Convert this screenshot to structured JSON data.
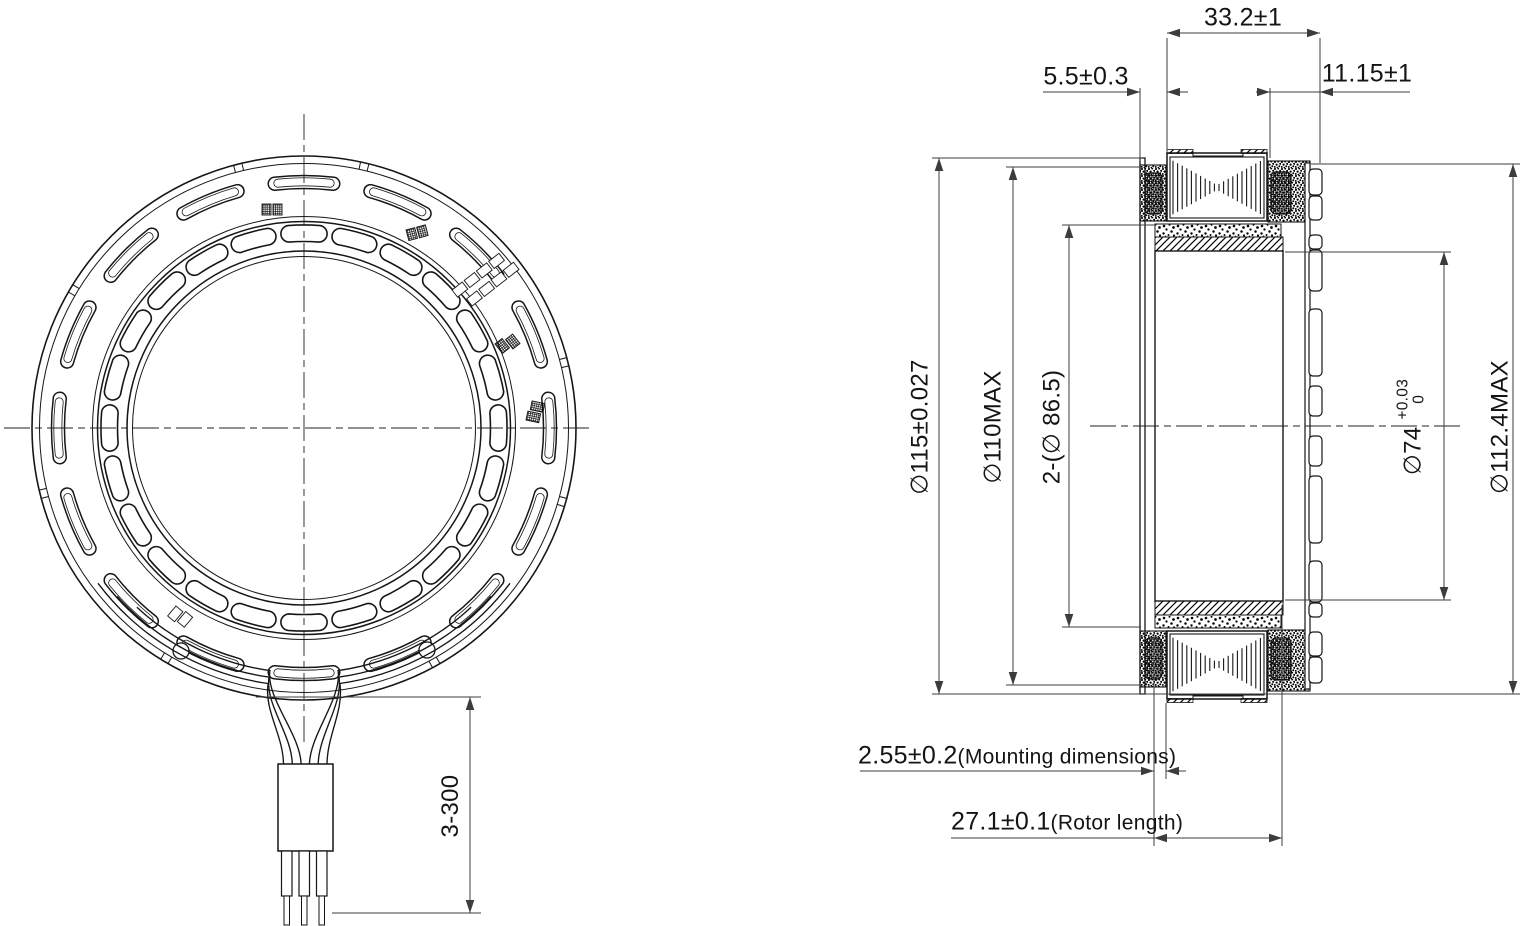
{
  "drawing": {
    "front_view": {
      "dim_wire_length": "3-300"
    },
    "section_view": {
      "dim_width_total": "33.2±1",
      "dim_width_left": "5.5±0.3",
      "dim_width_right": "11.15±1",
      "dim_outer_dia": "∅115±0.027",
      "dim_stator_dia": "∅110MAX",
      "dim_magnet_dia": "2-(∅ 86.5)",
      "dim_bore_dia": "∅74",
      "dim_bore_tol_upper": "+0.03",
      "dim_bore_tol_lower": "0",
      "dim_pcb_dia": "∅112.4MAX",
      "dim_mounting_value": "2.55±0.2",
      "dim_mounting_note": "(Mounting dimensions)",
      "dim_rotor_value": "27.1±0.1",
      "dim_rotor_note": "(Rotor length)"
    }
  }
}
